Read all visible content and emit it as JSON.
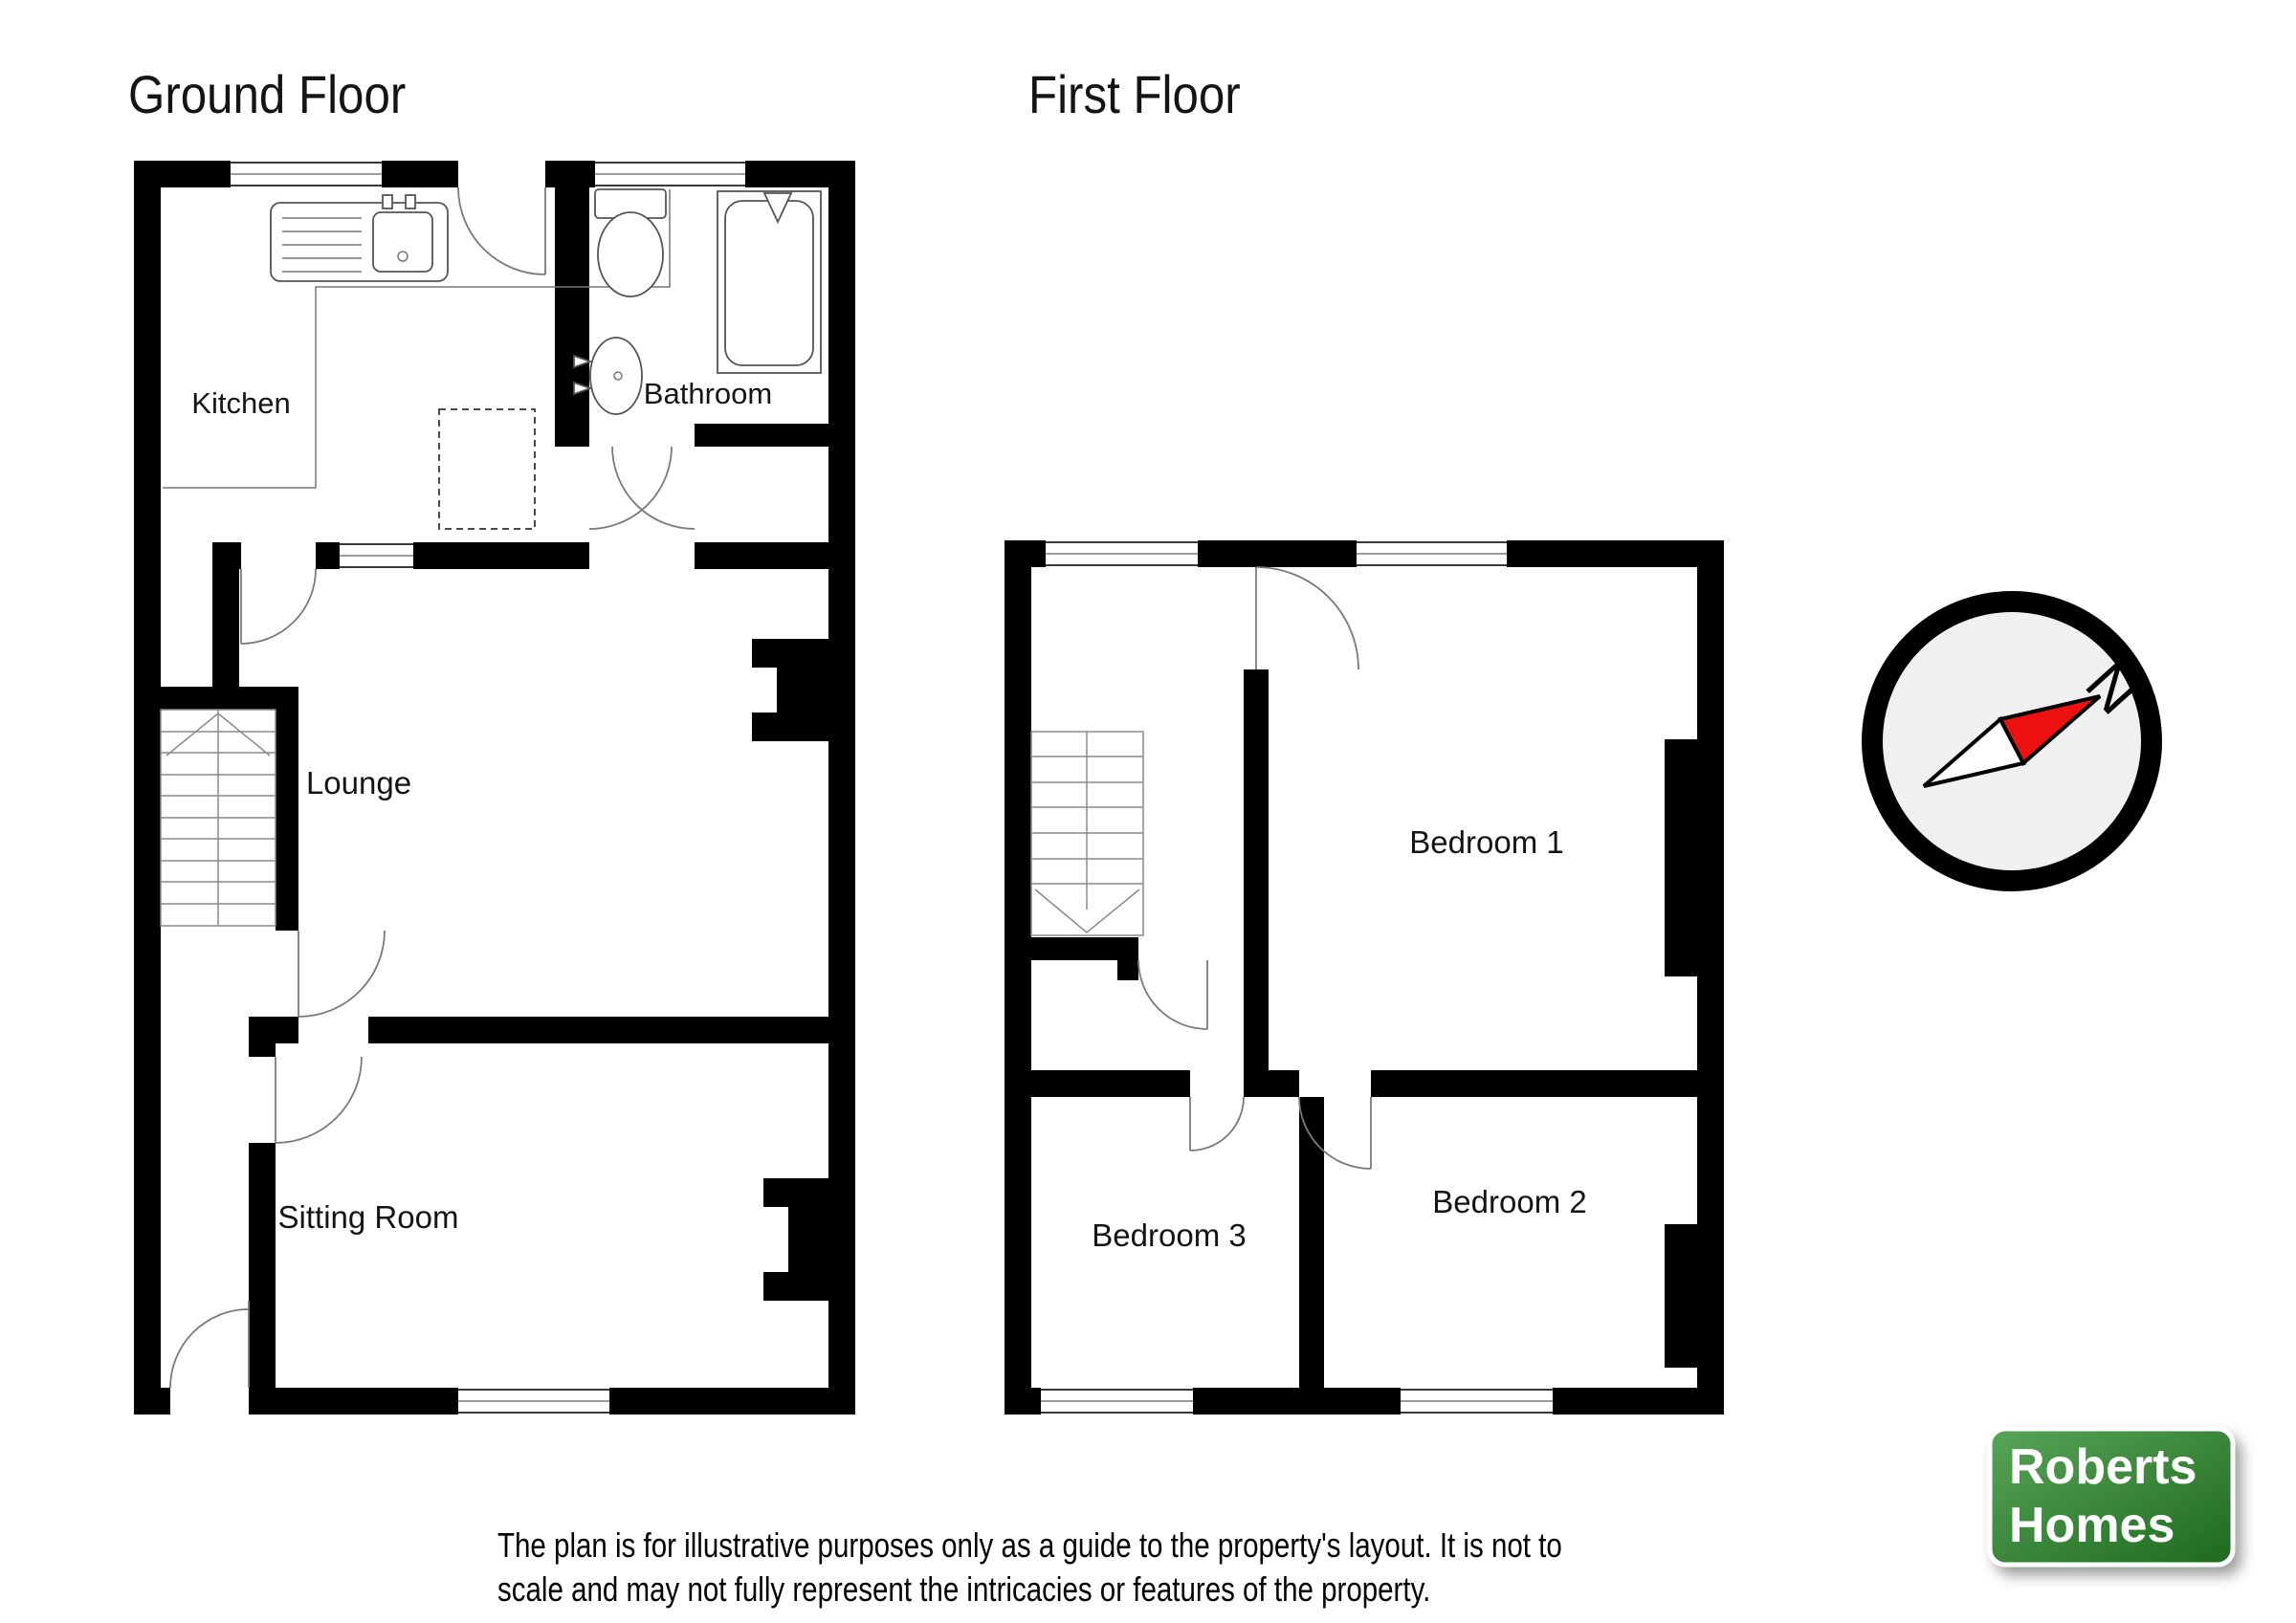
{
  "canvas": {
    "background": "#ffffff",
    "wall_color": "#000000"
  },
  "floors": {
    "ground": {
      "title": "Ground Floor",
      "rooms": {
        "kitchen": "Kitchen",
        "bathroom": "Bathroom",
        "lounge": "Lounge",
        "sitting_room": "Sitting Room"
      },
      "fixtures": [
        "kitchen-counter",
        "kitchen-sink",
        "appliance-space",
        "toilet",
        "wash-basin",
        "bath",
        "shower-head",
        "staircase-up",
        "fireplace-lounge",
        "fireplace-sitting-room"
      ]
    },
    "first": {
      "title": "First Floor",
      "rooms": {
        "bedroom1": "Bedroom 1",
        "bedroom2": "Bedroom 2",
        "bedroom3": "Bedroom 3"
      },
      "fixtures": [
        "staircase-down",
        "chimney-breast-bedroom1",
        "chimney-breast-bedroom2"
      ]
    }
  },
  "compass": {
    "north_label": "N",
    "needle_color": "#ee1111",
    "face_color": "#f0f0f0",
    "ring_color": "#000000"
  },
  "logo": {
    "line1": "Roberts",
    "line2": "Homes",
    "background_top": "#58a558",
    "background_bottom": "#1e691e",
    "text_color": "#ffffff"
  },
  "disclaimer": {
    "line1": "The plan is for illustrative purposes only as a guide to the property's layout. It is not to",
    "line2": "scale and may not fully represent the intricacies or features of the property."
  }
}
